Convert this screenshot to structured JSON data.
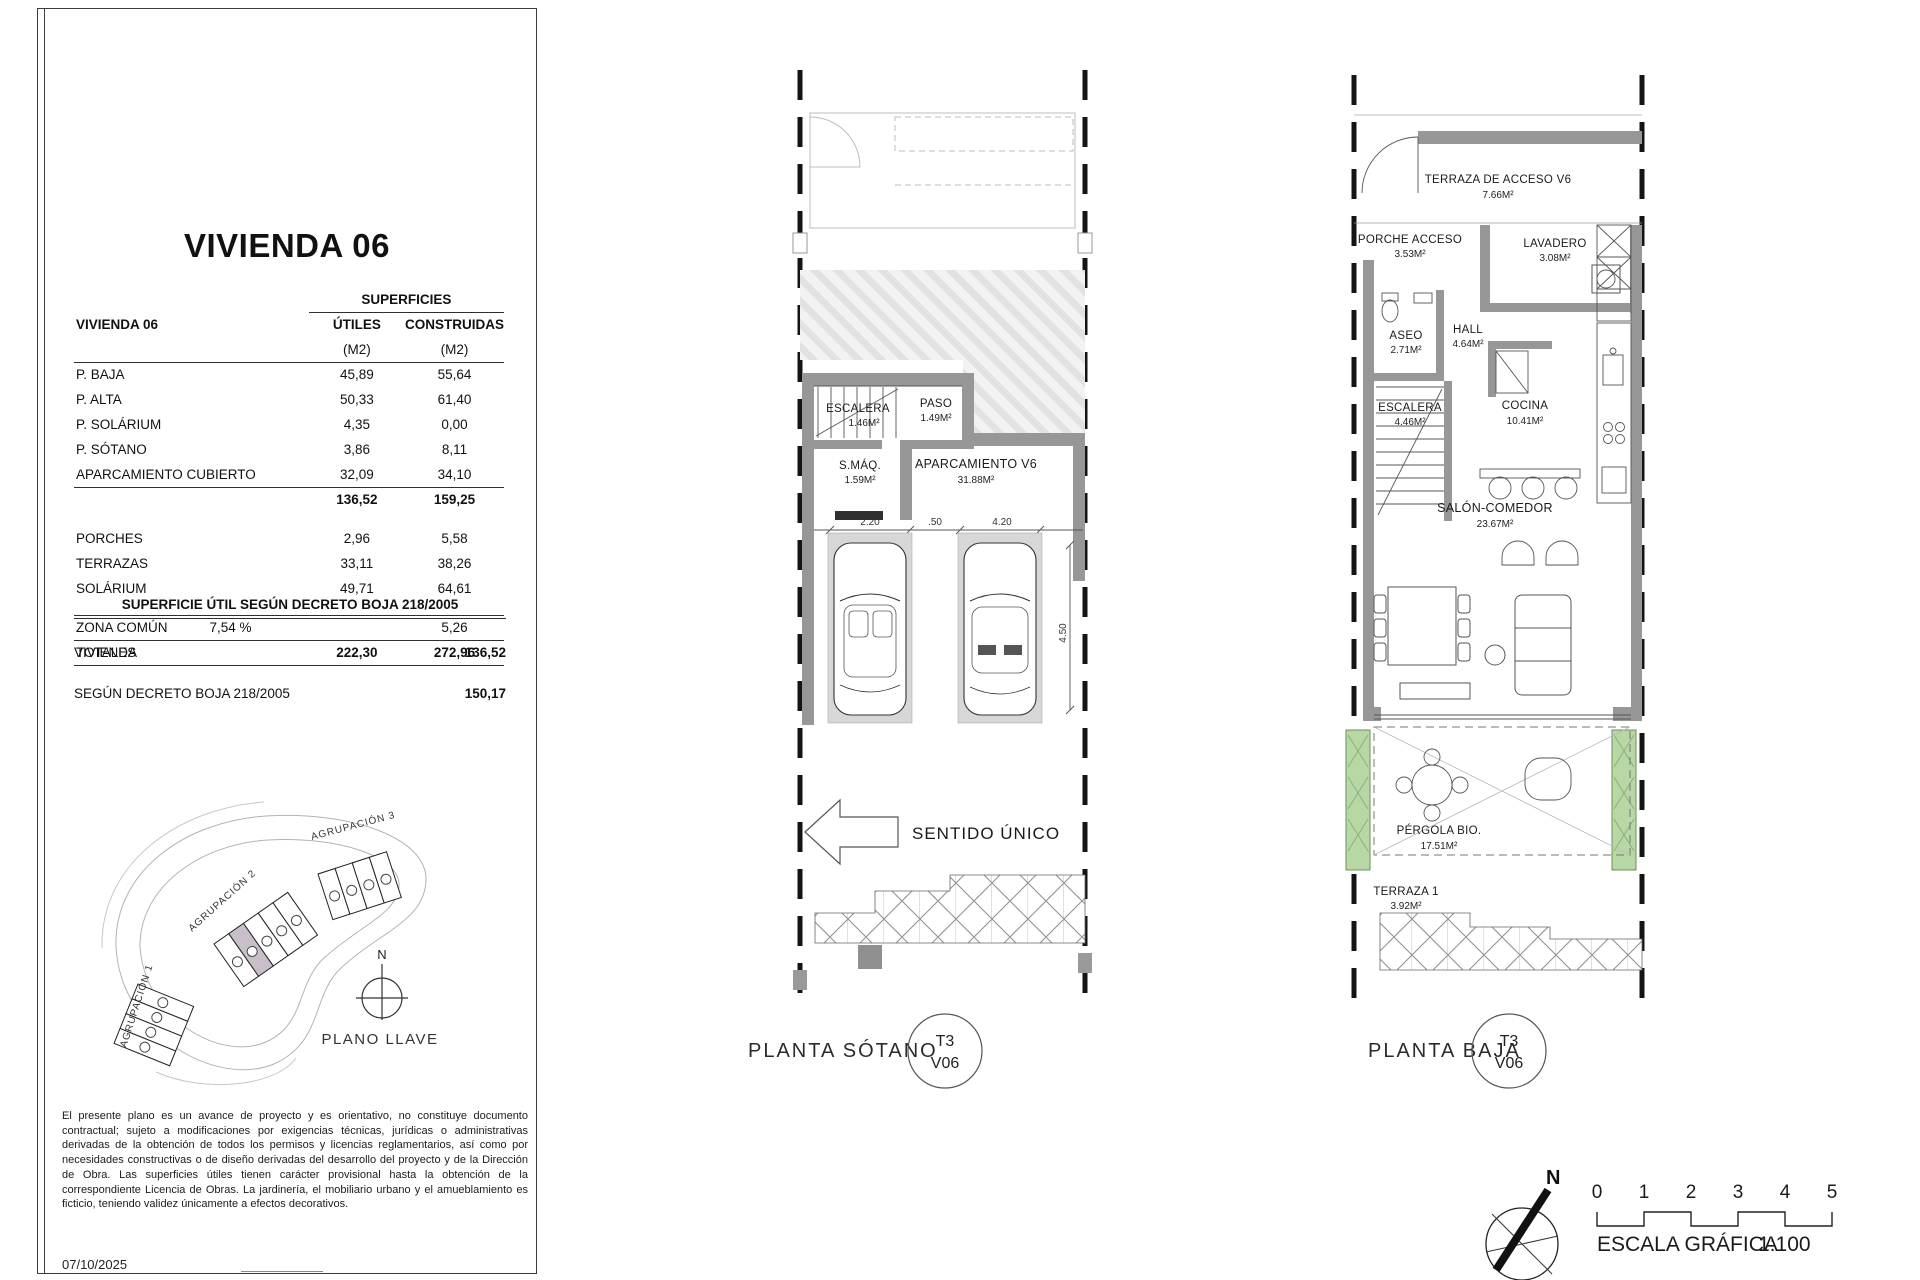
{
  "document": {
    "date": "07/10/2025",
    "disclaimer": "El presente plano es un avance de proyecto y es orientativo, no constituye documento contractual; sujeto a modificaciones por exigencias técnicas, jurídicas o administrativas derivadas de la obtención de todos los permisos y licencias reglamentarios, así como por necesidades constructivas o de diseño derivadas del desarrollo del proyecto y de la Dirección de Obra. Las superficies útiles tienen carácter provisional hasta la obtención de la correspondiente Licencia de Obras. La jardinería, el mobiliario urbano y el amueblamiento es ficticio, teniendo validez únicamente a efectos decorativos."
  },
  "panel": {
    "title": "VIVIENDA 06",
    "table": {
      "unit_header": "VIVIENDA 06",
      "group_header": "SUPERFICIES",
      "col_utiles": "ÚTILES",
      "col_construidas": "CONSTRUIDAS",
      "unit_m2": "(M2)",
      "rows": [
        {
          "label": "P. BAJA",
          "utiles": "45,89",
          "construidas": "55,64"
        },
        {
          "label": "P. ALTA",
          "utiles": "50,33",
          "construidas": "61,40"
        },
        {
          "label": "P. SOLÁRIUM",
          "utiles": "4,35",
          "construidas": "0,00"
        },
        {
          "label": "P. SÓTANO",
          "utiles": "3,86",
          "construidas": "8,11"
        },
        {
          "label": "APARCAMIENTO CUBIERTO",
          "utiles": "32,09",
          "construidas": "34,10"
        }
      ],
      "subtotal": {
        "utiles": "136,52",
        "construidas": "159,25"
      },
      "extra_rows": [
        {
          "label": "PORCHES",
          "utiles": "2,96",
          "construidas": "5,58"
        },
        {
          "label": "TERRAZAS",
          "utiles": "33,11",
          "construidas": "38,26"
        },
        {
          "label": "SOLÁRIUM",
          "utiles": "49,71",
          "construidas": "64,61"
        }
      ],
      "zona_comun": {
        "label": "ZONA COMÚN",
        "pct": "7,54 %",
        "construidas": "5,26"
      },
      "totals": {
        "label": "TOTALES",
        "utiles": "222,30",
        "construidas": "272,96"
      }
    },
    "decreto": {
      "title": "SUPERFICIE ÚTIL SEGÚN DECRETO BOJA 218/2005",
      "rows": [
        {
          "label": "VIVIENDA",
          "value": "136,52"
        },
        {
          "label": "SEGÚN DECRETO BOJA 218/2005",
          "value": "150,17"
        }
      ]
    },
    "key_plan": {
      "agrupacion_1": "AGRUPACIÓN 1",
      "agrupacion_2": "AGRUPACIÓN 2",
      "agrupacion_3": "AGRUPACIÓN 3",
      "north": "N",
      "caption": "PLANO LLAVE"
    }
  },
  "plans": {
    "sotano": {
      "caption": "PLANTA SÓTANO",
      "badge": {
        "top": "T3",
        "bottom": "V06"
      },
      "direction_label": "SENTIDO ÚNICO",
      "rooms": {
        "escalera": {
          "name": "ESCALERA",
          "area": "1.46M²"
        },
        "paso": {
          "name": "PASO",
          "area": "1.49M²"
        },
        "sala_maquinas": {
          "name": "S.MÁQ.",
          "area": "1.59M²"
        },
        "aparcamiento": {
          "name": "APARCAMIENTO V6",
          "area": "31.88M²"
        }
      },
      "dims": {
        "stall_1_width": "2.20",
        "gap": ".50",
        "stall_2_width": "4.20",
        "depth": "4.50"
      }
    },
    "baja": {
      "caption": "PLANTA BAJA",
      "badge": {
        "top": "T3",
        "bottom": "V06"
      },
      "rooms": {
        "terraza_acceso": {
          "name": "TERRAZA DE ACCESO V6",
          "area": "7.66M²"
        },
        "porche": {
          "name": "PORCHE ACCESO",
          "area": "3.53M²"
        },
        "lavadero": {
          "name": "LAVADERO",
          "area": "3.08M²"
        },
        "aseo": {
          "name": "ASEO",
          "area": "2.71M²"
        },
        "hall": {
          "name": "HALL",
          "area": "4.64M²"
        },
        "escalera": {
          "name": "ESCALERA",
          "area": "4.46M²"
        },
        "cocina": {
          "name": "COCINA",
          "area": "10.41M²"
        },
        "salon": {
          "name": "SALÓN-COMEDOR",
          "area": "23.67M²"
        },
        "pergola": {
          "name": "PÉRGOLA BIO.",
          "area": "17.51M²"
        },
        "terraza_1": {
          "name": "TERRAZA 1",
          "area": "3.92M²"
        }
      }
    }
  },
  "footer": {
    "north": "N",
    "scale_ticks": [
      "0",
      "1",
      "2",
      "3",
      "4",
      "5"
    ],
    "scale_label": "ESCALA GRÁFICA",
    "scale_ratio": "1:100"
  },
  "colors": {
    "wall_gray": "#979797",
    "planter_green": "#b7d7a5",
    "highlighted_unit": "#c9bfc9",
    "hatch_gray": "#e2e2e2"
  }
}
